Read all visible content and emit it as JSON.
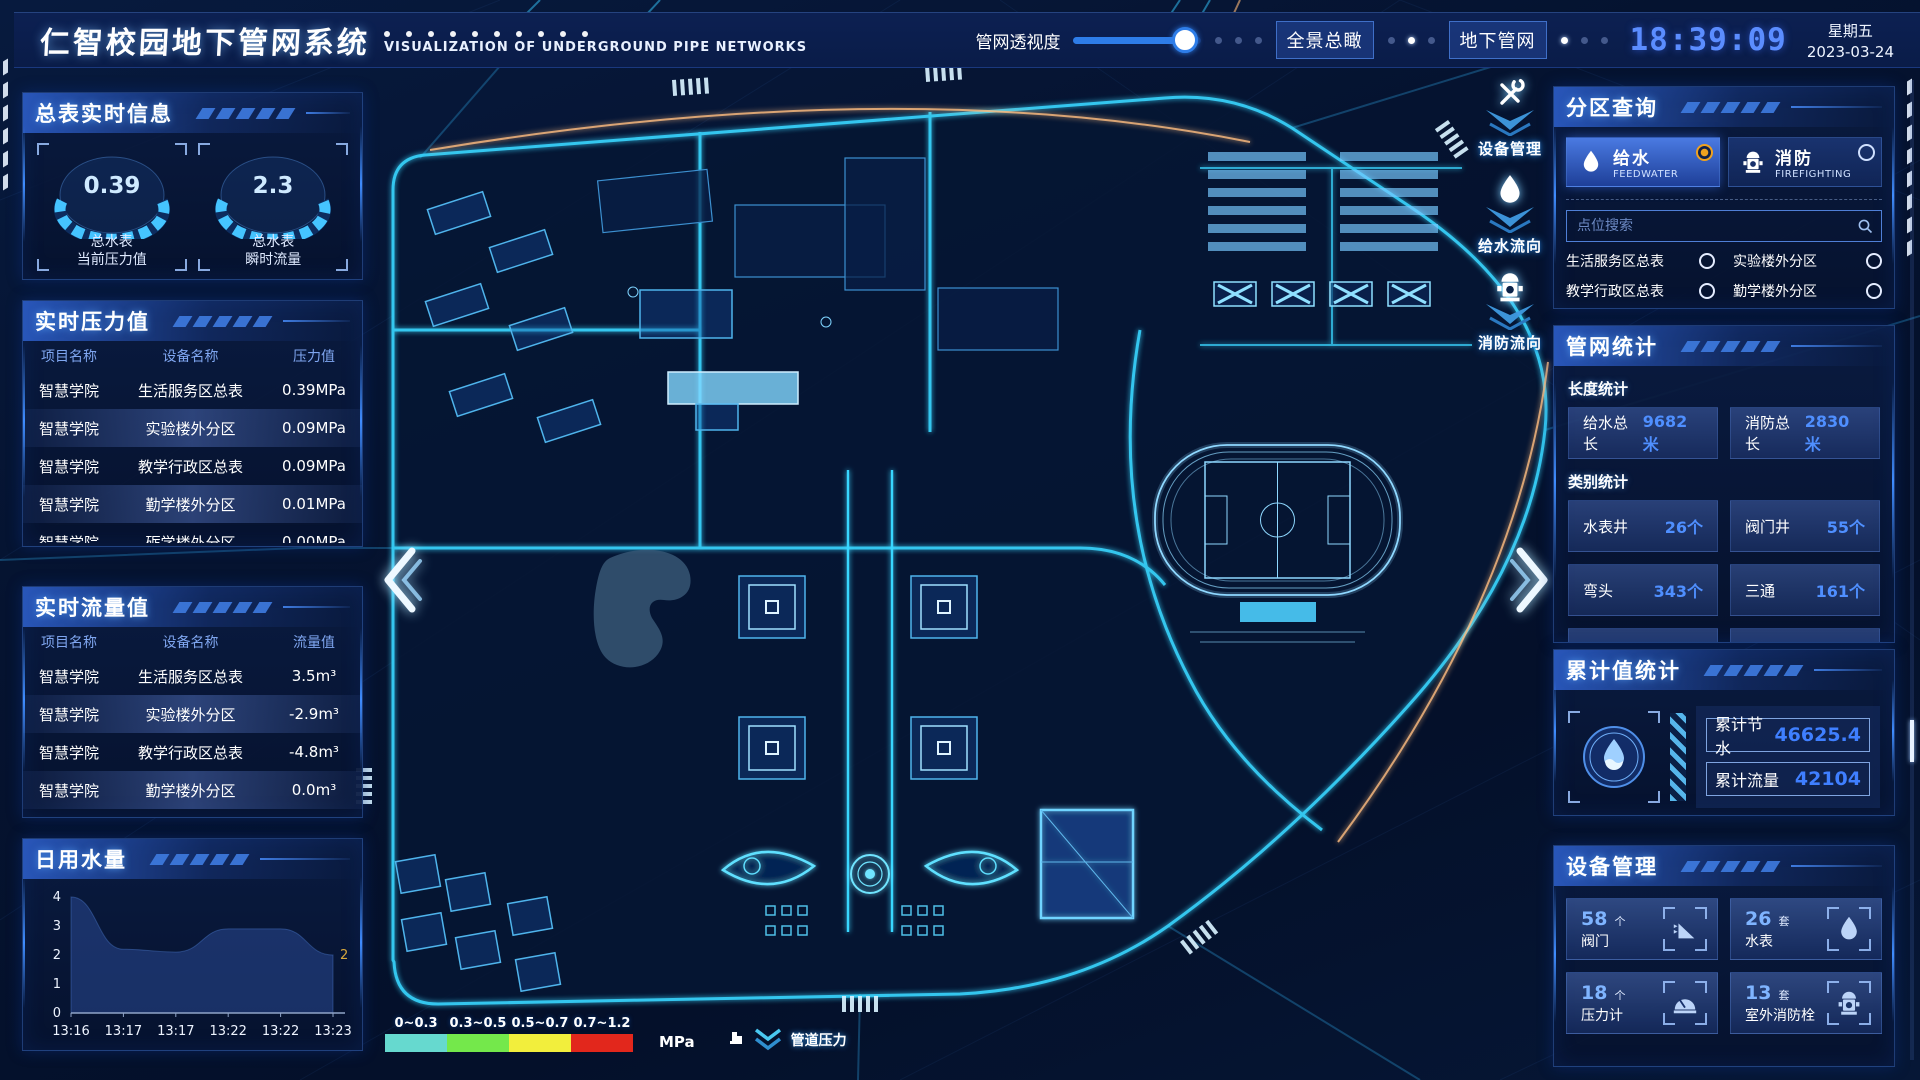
{
  "header": {
    "title": "仁智校园地下管网系统",
    "subtitle": "VISUALIZATION OF UNDERGROUND PIPE NETWORKS",
    "slider_label": "管网透视度",
    "slider_percent": 88,
    "btn_overview": "全景总瞰",
    "btn_underground": "地下管网",
    "clock_time": "18:39:09",
    "weekday": "星期五",
    "date": "2023-03-24"
  },
  "left": {
    "realtime_info": {
      "title": "总表实时信息",
      "gauges": [
        {
          "value": "0.39",
          "line1": "总水表",
          "line2": "当前压力值"
        },
        {
          "value": "2.3",
          "line1": "总水表",
          "line2": "瞬时流量"
        }
      ]
    },
    "pressure_panel": {
      "title": "实时压力值",
      "headers": [
        "项目名称",
        "设备名称",
        "压力值"
      ],
      "rows": [
        {
          "project": "智慧学院",
          "device": "生活服务区总表",
          "value": "0.39MPa"
        },
        {
          "project": "智慧学院",
          "device": "实验楼外分区",
          "value": "0.09MPa"
        },
        {
          "project": "智慧学院",
          "device": "教学行政区总表",
          "value": "0.09MPa"
        },
        {
          "project": "智慧学院",
          "device": "勤学楼外分区",
          "value": "0.01MPa"
        },
        {
          "project": "智慧学院",
          "device": "砺学楼外分区",
          "value": "0.00MPa"
        }
      ]
    },
    "flow_panel": {
      "title": "实时流量值",
      "headers": [
        "项目名称",
        "设备名称",
        "流量值"
      ],
      "rows": [
        {
          "project": "智慧学院",
          "device": "生活服务区总表",
          "value": "3.5m³"
        },
        {
          "project": "智慧学院",
          "device": "实验楼外分区",
          "value": "-2.9m³"
        },
        {
          "project": "智慧学院",
          "device": "教学行政区总表",
          "value": "-4.8m³"
        },
        {
          "project": "智慧学院",
          "device": "勤学楼外分区",
          "value": "0.0m³"
        },
        {
          "project": "智慧学院",
          "device": "砺学楼外分区",
          "value": "2.3m³"
        }
      ]
    },
    "daily_water": {
      "title": "日用水量"
    }
  },
  "chart_data": {
    "type": "area",
    "title": "日用水量",
    "x": [
      "13:16",
      "13:17",
      "13:17",
      "13:22",
      "13:22",
      "13:23"
    ],
    "values": [
      4,
      2.2,
      2.1,
      2.9,
      2.9,
      2
    ],
    "ylim": [
      0,
      4
    ],
    "yticks": [
      0,
      1,
      2,
      3,
      4
    ],
    "end_label": "2",
    "end_label_color": "#d8a83c",
    "area_color": "rgba(38,68,138,0.6)"
  },
  "right": {
    "zone_query": {
      "title": "分区查询",
      "tabs": [
        {
          "label": "给水",
          "sub": "FEEDWATER",
          "selected": true
        },
        {
          "label": "消防",
          "sub": "FIREFIGHTING",
          "selected": false
        }
      ],
      "search_placeholder": "点位搜索",
      "points": [
        "生活服务区总表",
        "实验楼外分区",
        "教学行政区总表",
        "勤学楼外分区",
        "砺学楼外分区",
        "宿舍区泵房"
      ]
    },
    "network_stats": {
      "title": "管网统计",
      "length_heading": "长度统计",
      "length_stats": [
        {
          "label": "给水总长",
          "value": "9682米"
        },
        {
          "label": "消防总长",
          "value": "2830米"
        }
      ],
      "category_heading": "类别统计",
      "category_stats": [
        {
          "label": "水表井",
          "value": "26个"
        },
        {
          "label": "阀门井",
          "value": "55个"
        },
        {
          "label": "弯头",
          "value": "343个"
        },
        {
          "label": "三通",
          "value": "161个"
        }
      ]
    },
    "cumulative": {
      "title": "累计值统计",
      "rows": [
        {
          "label": "累计节水",
          "value": "46625.4"
        },
        {
          "label": "累计流量",
          "value": "42104"
        }
      ]
    },
    "device_mgmt": {
      "title": "设备管理",
      "cards": [
        {
          "count": "58",
          "unit": "个",
          "label": "阀门",
          "icon": "valve-icon"
        },
        {
          "count": "26",
          "unit": "套",
          "label": "水表",
          "icon": "water-meter-icon"
        },
        {
          "count": "18",
          "unit": "个",
          "label": "压力计",
          "icon": "pressure-gauge-icon"
        },
        {
          "count": "13",
          "unit": "套",
          "label": "室外消防栓",
          "icon": "hydrant-icon"
        }
      ]
    }
  },
  "map": {
    "fabs": [
      {
        "label": "设备管理",
        "icon": "wrench-icon"
      },
      {
        "label": "给水流向",
        "icon": "water-drop-icon"
      },
      {
        "label": "消防流向",
        "icon": "hydrant-icon"
      }
    ],
    "legend": {
      "ranges": [
        {
          "label": "0~0.3",
          "color": "#66d9cf"
        },
        {
          "label": "0.3~0.5",
          "color": "#74e84b"
        },
        {
          "label": "0.5~0.7",
          "color": "#f2ee3c"
        },
        {
          "label": "0.7~1.2",
          "color": "#e2271c"
        }
      ],
      "unit": "MPa",
      "pressure_label": "管道压力"
    }
  }
}
